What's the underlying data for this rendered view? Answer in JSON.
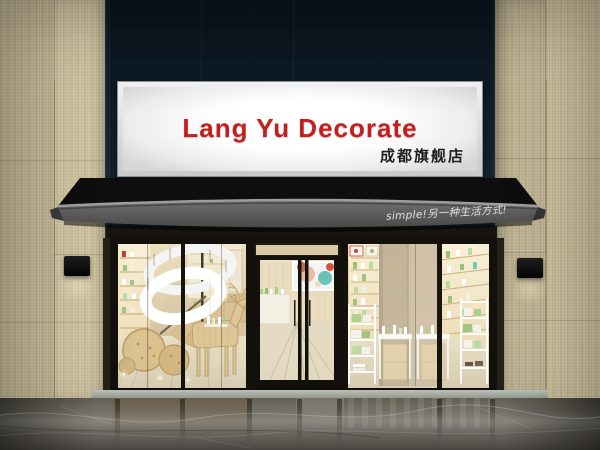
{
  "sign": {
    "title": "Lang Yu Decorate",
    "subtitle": "成都旗舰店"
  },
  "awning": {
    "slogan": "simple!另一种生活方式!"
  },
  "colors": {
    "sign_title": "#c41f1f",
    "sign_subtitle": "#1e1e1e",
    "sign_lightbox": "#ffffff",
    "awning_fabric": "#5a5a5a",
    "awning_slogan": "#ececec",
    "curtain_glass": "#13222e",
    "wall_tile": "#cdc19e",
    "storefront_frame": "#17140e",
    "interior_wall": "#e6d7b6",
    "product_green": "#97c276",
    "wood_tan": "#d8bd8b",
    "floor_marble": "#7b7870",
    "threshold": "#aab0a4"
  }
}
